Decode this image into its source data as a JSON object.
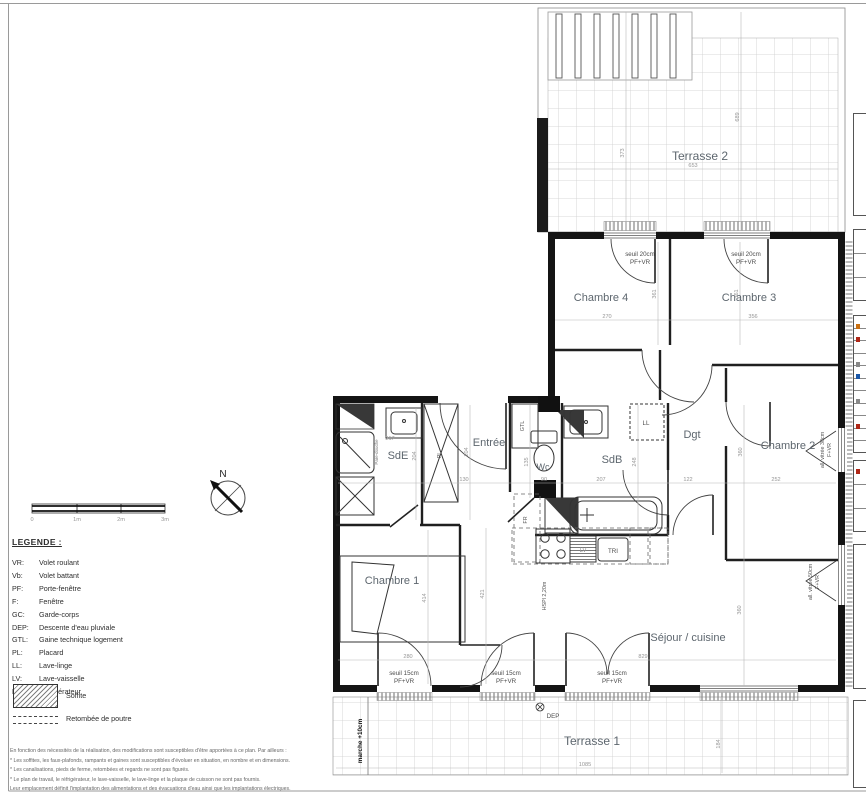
{
  "plan": {
    "labels": [
      {
        "n": "terrasse2-label",
        "t": "Terrasse 2",
        "x": 700,
        "y": 160,
        "c": "room-lg"
      },
      {
        "n": "terrasse1-label",
        "t": "Terrasse 1",
        "x": 592,
        "y": 745,
        "c": "room-lg"
      },
      {
        "n": "chambre4-label",
        "t": "Chambre 4",
        "x": 601,
        "y": 301,
        "c": "room"
      },
      {
        "n": "chambre3-label",
        "t": "Chambre 3",
        "x": 749,
        "y": 301,
        "c": "room"
      },
      {
        "n": "chambre2-label",
        "t": "Chambre 2",
        "x": 788,
        "y": 449,
        "c": "room"
      },
      {
        "n": "chambre1-label",
        "t": "Chambre 1",
        "x": 392,
        "y": 584,
        "c": "room"
      },
      {
        "n": "sejour-cuisine-label",
        "t": "Séjour / cuisine",
        "x": 688,
        "y": 641,
        "c": "room"
      },
      {
        "n": "sdb-label",
        "t": "SdB",
        "x": 612,
        "y": 463,
        "c": "room"
      },
      {
        "n": "sde-label",
        "t": "SdE",
        "x": 398,
        "y": 459,
        "c": "room"
      },
      {
        "n": "entree-label",
        "t": "Entrée",
        "x": 489,
        "y": 446,
        "c": "room"
      },
      {
        "n": "dgt-label",
        "t": "Dgt",
        "x": 692,
        "y": 438,
        "c": "room"
      },
      {
        "n": "wc-label",
        "t": "Wc",
        "x": 543,
        "y": 470,
        "c": "room-sm"
      },
      {
        "n": "gtl-label",
        "t": "GTL",
        "x": 524,
        "y": 426,
        "c": "ann-sm",
        "r": 1
      },
      {
        "n": "pl-label",
        "t": "PL",
        "x": 441,
        "y": 455,
        "c": "ann-sm",
        "r": 1
      },
      {
        "n": "ll-label",
        "t": "LL",
        "x": 646,
        "y": 425,
        "c": "ann"
      },
      {
        "n": "lv-label",
        "t": "LV",
        "x": 583,
        "y": 552,
        "c": "ann-lt"
      },
      {
        "n": "tri-label",
        "t": "TRI",
        "x": 613,
        "y": 553,
        "c": "ann"
      },
      {
        "n": "fr-label",
        "t": "FR",
        "x": 527,
        "y": 520,
        "c": "ann-sm",
        "r": 1
      },
      {
        "n": "dep-label",
        "t": "DEP",
        "x": 553,
        "y": 718,
        "c": "ann"
      },
      {
        "n": "seuil-ch4-line1",
        "t": "seuil 20cm",
        "x": 640,
        "y": 256,
        "c": "ann"
      },
      {
        "n": "seuil-ch4-line2",
        "t": "PF+VR",
        "x": 640,
        "y": 264,
        "c": "ann"
      },
      {
        "n": "seuil-ch3-line1",
        "t": "seuil 20cm",
        "x": 746,
        "y": 256,
        "c": "ann"
      },
      {
        "n": "seuil-ch3-line2",
        "t": "PF+VR",
        "x": 746,
        "y": 264,
        "c": "ann"
      },
      {
        "n": "seuil-door1-line1",
        "t": "seuil 15cm",
        "x": 404,
        "y": 675,
        "c": "ann"
      },
      {
        "n": "seuil-door1-line2",
        "t": "PF+VR",
        "x": 404,
        "y": 683,
        "c": "ann"
      },
      {
        "n": "seuil-door2-line1",
        "t": "seuil 15cm",
        "x": 506,
        "y": 675,
        "c": "ann"
      },
      {
        "n": "seuil-door2-line2",
        "t": "PF+VR",
        "x": 506,
        "y": 683,
        "c": "ann"
      },
      {
        "n": "seuil-door3-line1",
        "t": "seuil 15cm",
        "x": 612,
        "y": 675,
        "c": "ann"
      },
      {
        "n": "seuil-door3-line2",
        "t": "PF+VR",
        "x": 612,
        "y": 683,
        "c": "ann"
      },
      {
        "n": "allege-ch2-line1",
        "t": "all. vitrée 30cm",
        "x": 824,
        "y": 450,
        "c": "ann-sm",
        "r": 1
      },
      {
        "n": "allege-ch2-line2",
        "t": "F+VR",
        "x": 831,
        "y": 450,
        "c": "ann-sm",
        "r": 1
      },
      {
        "n": "allege-sejour-line1",
        "t": "all. vitrée 50cm",
        "x": 812,
        "y": 582,
        "c": "ann-sm",
        "r": 1
      },
      {
        "n": "allege-sejour-line2",
        "t": "F+VR",
        "x": 819,
        "y": 582,
        "c": "ann-sm",
        "r": 1
      },
      {
        "n": "hspl-label",
        "t": "HSPl 2,20m",
        "x": 546,
        "y": 596,
        "c": "ann-sm",
        "r": 1
      },
      {
        "n": "marche-label",
        "t": "marche +10cm",
        "x": 362,
        "y": 741,
        "c": "ann-bold",
        "r": 1
      },
      {
        "n": "pare-douche-label",
        "t": "Pare-douche",
        "x": 378,
        "y": 452,
        "c": "ann-xs",
        "r": 1
      },
      {
        "n": "compass-n-label",
        "t": "N",
        "x": 223,
        "y": 477,
        "c": "compass-n"
      },
      {
        "n": "dim-terrasse2-w",
        "t": "653",
        "x": 693,
        "y": 167,
        "c": "dim"
      },
      {
        "n": "dim-terrasse2-h1",
        "t": "373",
        "x": 624,
        "y": 153,
        "c": "dim",
        "r": 1
      },
      {
        "n": "dim-terrasse2-h2",
        "t": "689",
        "x": 739,
        "y": 117,
        "c": "dim",
        "r": 1
      },
      {
        "n": "dim-ch4-w",
        "t": "270",
        "x": 607,
        "y": 318,
        "c": "dim"
      },
      {
        "n": "dim-ch3-w",
        "t": "356",
        "x": 753,
        "y": 318,
        "c": "dim"
      },
      {
        "n": "dim-ch4-h",
        "t": "361",
        "x": 656,
        "y": 294,
        "c": "dim",
        "r": 1
      },
      {
        "n": "dim-ch3-h",
        "t": "361",
        "x": 738,
        "y": 294,
        "c": "dim",
        "r": 1
      },
      {
        "n": "dim-dgt-w",
        "t": "122",
        "x": 688,
        "y": 481,
        "c": "dim"
      },
      {
        "n": "dim-ch2-w",
        "t": "252",
        "x": 776,
        "y": 481,
        "c": "dim"
      },
      {
        "n": "dim-ch2-h",
        "t": "360",
        "x": 742,
        "y": 452,
        "c": "dim",
        "r": 1
      },
      {
        "n": "dim-entree-w",
        "t": "130",
        "x": 464,
        "y": 481,
        "c": "dim"
      },
      {
        "n": "dim-wc-w",
        "t": "90",
        "x": 544,
        "y": 481,
        "c": "dim"
      },
      {
        "n": "dim-sdb-w",
        "t": "207",
        "x": 601,
        "y": 481,
        "c": "dim"
      },
      {
        "n": "dim-entree-h",
        "t": "204",
        "x": 468,
        "y": 452,
        "c": "dim",
        "r": 1
      },
      {
        "n": "dim-wc-h",
        "t": "135",
        "x": 528,
        "y": 462,
        "c": "dim",
        "r": 1
      },
      {
        "n": "dim-sdb-h",
        "t": "248",
        "x": 636,
        "y": 462,
        "c": "dim",
        "r": 1
      },
      {
        "n": "dim-sde-w",
        "t": "217",
        "x": 390,
        "y": 440,
        "c": "dim"
      },
      {
        "n": "dim-sde-h",
        "t": "204",
        "x": 416,
        "y": 456,
        "c": "dim",
        "r": 1
      },
      {
        "n": "dim-ch1-h1",
        "t": "414",
        "x": 426,
        "y": 598,
        "c": "dim",
        "r": 1
      },
      {
        "n": "dim-ch1-h2",
        "t": "421",
        "x": 484,
        "y": 594,
        "c": "dim",
        "r": 1
      },
      {
        "n": "dim-ch1-w",
        "t": "280",
        "x": 408,
        "y": 658,
        "c": "dim"
      },
      {
        "n": "dim-sejour-w",
        "t": "829",
        "x": 643,
        "y": 658,
        "c": "dim"
      },
      {
        "n": "dim-sejour-h",
        "t": "360",
        "x": 741,
        "y": 610,
        "c": "dim",
        "r": 1
      },
      {
        "n": "dim-terrasse1-w",
        "t": "1085",
        "x": 585,
        "y": 766,
        "c": "dim"
      },
      {
        "n": "dim-terrasse1-h",
        "t": "184",
        "x": 720,
        "y": 744,
        "c": "dim",
        "r": 1
      },
      {
        "n": "scale-tick-0",
        "t": "0",
        "x": 32,
        "y": 521,
        "c": "dim"
      },
      {
        "n": "scale-tick-1m",
        "t": "1m",
        "x": 77,
        "y": 521,
        "c": "dim"
      },
      {
        "n": "scale-tick-2m",
        "t": "2m",
        "x": 121,
        "y": 521,
        "c": "dim"
      },
      {
        "n": "scale-tick-3m",
        "t": "3m",
        "x": 165,
        "y": 521,
        "c": "dim"
      }
    ]
  },
  "legend": {
    "title": "LEGENDE :",
    "items": [
      {
        "abbr": "VR:",
        "label": "Volet roulant"
      },
      {
        "abbr": "Vb:",
        "label": "Volet battant"
      },
      {
        "abbr": "PF:",
        "label": "Porte-fenêtre"
      },
      {
        "abbr": "F:",
        "label": "Fenêtre"
      },
      {
        "abbr": "GC:",
        "label": "Garde-corps"
      },
      {
        "abbr": "DEP:",
        "label": "Descente d'eau pluviale"
      },
      {
        "abbr": "GTL:",
        "label": "Gaine technique logement"
      },
      {
        "abbr": "PL:",
        "label": "Placard"
      },
      {
        "abbr": "LL:",
        "label": "Lave-linge"
      },
      {
        "abbr": "LV:",
        "label": "Lave-vaisselle"
      },
      {
        "abbr": "R:",
        "label": "Réfrigérateur"
      }
    ],
    "soffite_label": "Soffite",
    "retombee_label": "Retombée de poutre"
  },
  "footer": {
    "lines": [
      "En fonction des nécessités de la réalisation, des modifications sont susceptibles d'être apportées à ce plan. Par ailleurs :",
      "* Les soffites, les faux-plafonds, rampants et gaines sont susceptibles d'évoluer en situation, en nombre et en dimensions.",
      "* Les canalisations, pieds de ferme, retombées et regards ne sont pas figurés.",
      "* Le plan de travail, le réfrigérateur, le lave-vaisselle, le lave-linge et la plaque de cuisson ne sont pas fournis.",
      "Leur emplacement définit l'implantation des alimentations et des évacuations d'eau ainsi que les implantations électriques."
    ]
  },
  "colors": {
    "wall": "#141414",
    "room_label": "#5d666e",
    "dim_text": "#969696",
    "grid": "#cdcdcd"
  }
}
